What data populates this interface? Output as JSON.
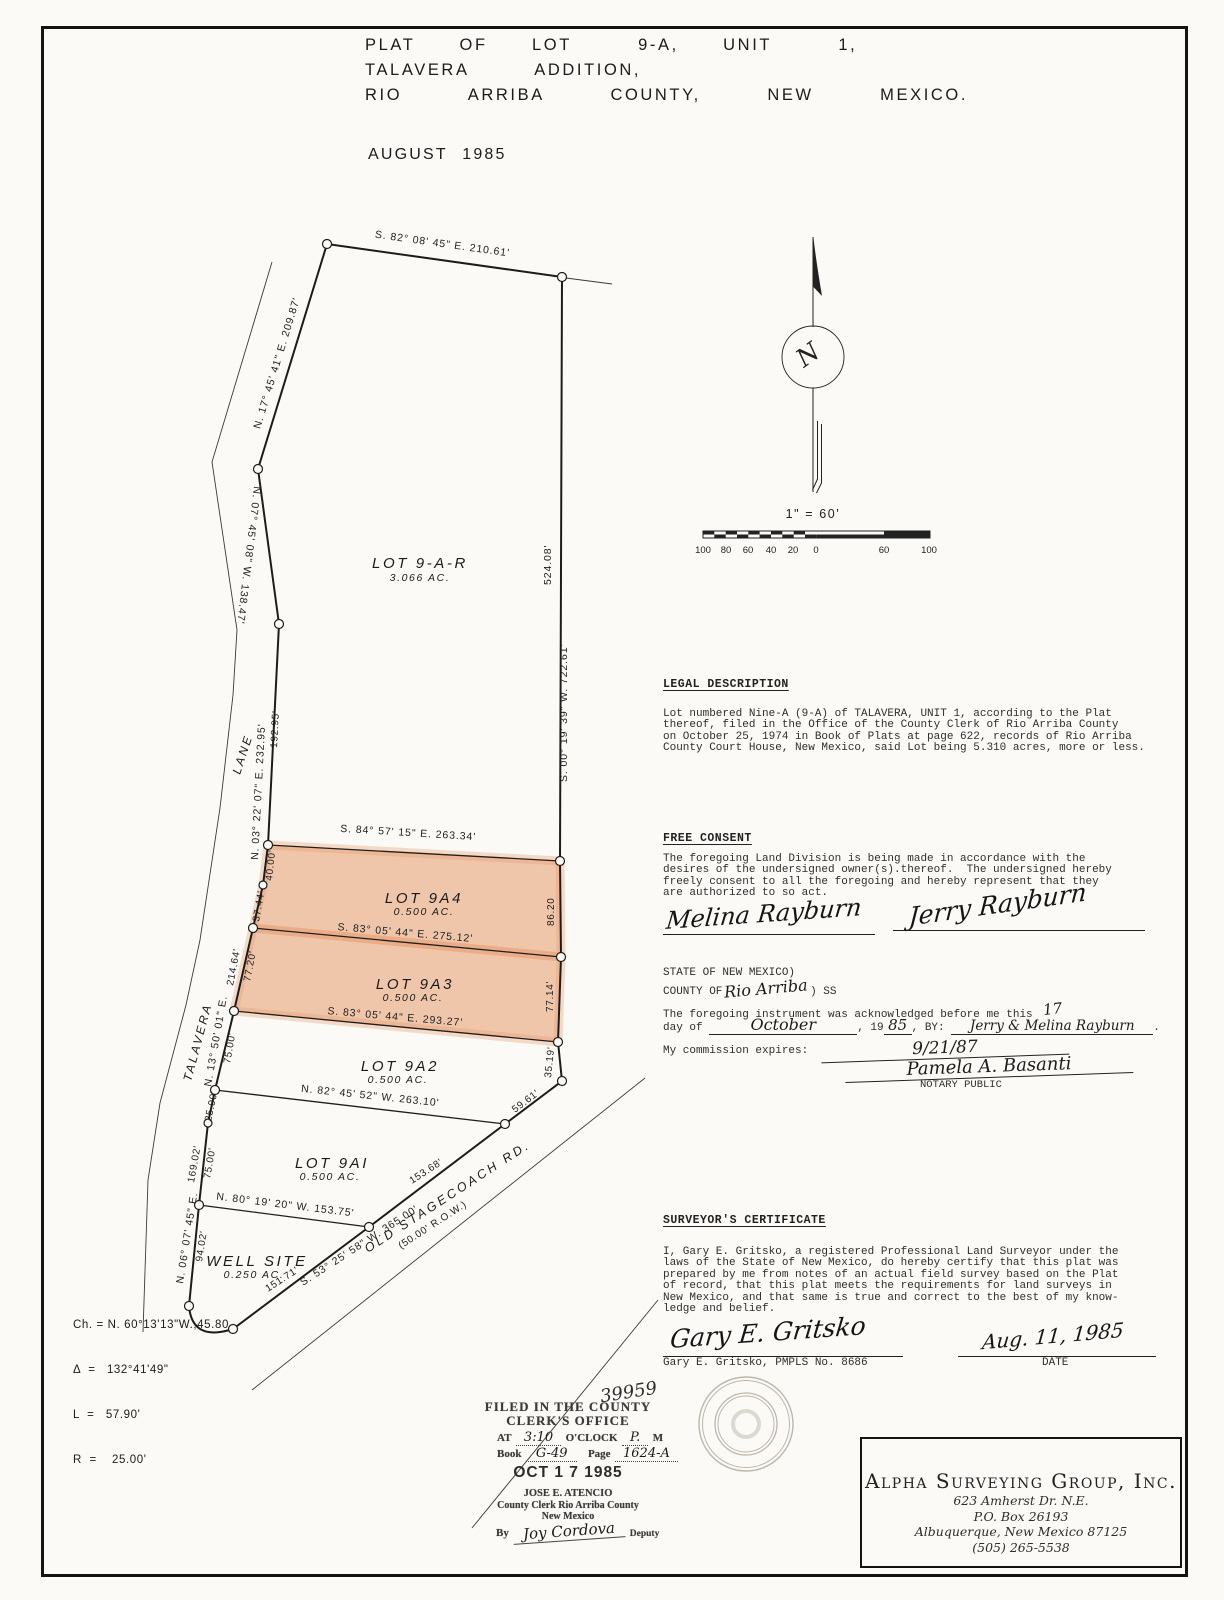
{
  "title": {
    "line1": "PLAT  OF  LOT   9-A,  UNIT   1,",
    "line2": "TALAVERA   ADDITION,",
    "line3": "RIO   ARRIBA   COUNTY,   NEW   MEXICO.",
    "date": "AUGUST  1985"
  },
  "north": {
    "letter": "N",
    "scale_label": "1\" = 60'",
    "ticks": [
      "100",
      "80",
      "60",
      "40",
      "20",
      "0",
      "60",
      "100"
    ]
  },
  "drawing": {
    "lane_upper": "LANE",
    "lane_lower": "TALAVERA",
    "road_name": "OLD  STAGECOACH  RD.",
    "road_row": "(50.00'  R.O.W.)",
    "b_top": "S.  82°  08'  45\"   E.    210.61'",
    "b_nw1": "N. 17° 45' 41\"  E.   209.87'",
    "b_nw2": "N. 07° 45' 08\" W. 138.47'",
    "b_w1": "N. 03° 22' 07\"  E.   232.95'",
    "d_w1_inner": "192.95'",
    "b_e_outer": "S. 00° 19' 39\" W. 722.61'",
    "d_e_inner": "524.08'",
    "b_9a4_top": "S.  84°  57' 15\"  E.  263.34'",
    "b_9a4_bot": "S.  83°  05' 44\"  E.  275.12'",
    "b_9a3_bot": "S.  83°  05' 44\"  E.  293.27'",
    "b_9a2_bot": "N.   82°  45'  52\"  W.  263.10'",
    "b_9a1_bot": "N.  80°  19'  20\"  W.  153.75'",
    "b_w2": "N. 13° 50' 01\" E.",
    "b_w3": "N. 06° 07' 45\" E.",
    "b_road": "S.  53°  25'  58\"  W.  365.00'",
    "d_40": "40.00'",
    "d_3744": "37.44'",
    "d_8620": "86.20",
    "d_21464": "214.64'",
    "d_7720": "77.20'",
    "d_7714": "77.14'",
    "d_3519": "35.19'",
    "d_5961": "59.61'",
    "d_7500a": "75.00'",
    "d_2500": "25.00'",
    "d_16902": "169.02'",
    "d_7500b": "75.00'",
    "d_9402": "94.02'",
    "d_15368": "153.68'",
    "d_15171": "151.71'",
    "lots": {
      "r": {
        "name": "LOT  9-A-R",
        "area": "3.066   AC."
      },
      "a4": {
        "name": "LOT  9A4",
        "area": "0.500   AC."
      },
      "a3": {
        "name": "LOT  9A3",
        "area": "0.500   AC."
      },
      "a2": {
        "name": "LOT  9A2",
        "area": "0.500    AC."
      },
      "a1": {
        "name": "LOT  9AI",
        "area": "0.500   AC."
      },
      "well": {
        "name": "WELL   SITE",
        "area": "0.250   AC."
      }
    },
    "curve": {
      "ch": "Ch. = N. 60°13'13\"W.,45.80",
      "delta": "Δ  =   132°41'49\"",
      "l": "L  =   57.90'",
      "r": "R  =    25.00'"
    }
  },
  "legal": {
    "heading": "LEGAL DESCRIPTION",
    "body": [
      "Lot numbered Nine-A (9-A) of TALAVERA, UNIT 1, according to the Plat",
      "thereof, filed in the Office of the County Clerk of Rio Arriba County",
      "on October 25, 1974 in Book of Plats at page 622, records of Rio Arriba",
      "County Court House, New Mexico, said Lot being 5.310 acres, more or less."
    ]
  },
  "consent": {
    "heading": "FREE CONSENT",
    "body": [
      "The foregoing Land Division is being made in accordance with the",
      "desires of the undersigned owner(s).thereof.  The undersigned hereby",
      "freely consent to all the foregoing and hereby represent that they",
      "are authorized to so act."
    ],
    "sig1": "Melina Rayburn",
    "sig2": "Jerry Rayburn"
  },
  "notary": {
    "state": "STATE OF NEW MEXICO)",
    "county_prefix": "COUNTY OF",
    "county_hand": "Rio Arriba",
    "ss": ") SS",
    "ack1": "The foregoing instrument was acknowledged before me this",
    "day_hand": "17",
    "day_of": "day of ",
    "year_pre": ", 19",
    "month_hand": "October",
    "year_hand": "85",
    "by_label": ", BY: ",
    "names_hand": "Jerry & Melina Rayburn",
    "period": ".",
    "expires_label": "My commission expires:",
    "expires_hand": "9/21/87",
    "notary_sig": "Pamela A. Basanti",
    "notary_title": "NOTARY PUBLIC"
  },
  "certificate": {
    "heading": "SURVEYOR'S CERTIFICATE",
    "body": [
      "I, Gary E. Gritsko, a registered Professional Land Surveyor under the",
      "laws of the State of New Mexico, do hereby certify that this plat was",
      "prepared by me from notes of an actual field survey based on the Plat",
      "of record, that this plat meets the requirements for land surveys in",
      "New Mexico, and that same is true and correct to the best of my know-",
      "ledge and belief."
    ],
    "sig": "Gary E. Gritsko",
    "sig_printed": "Gary E. Gritsko, PMPLS No. 8686",
    "date_hand": "Aug. 11, 1985",
    "date_label": "DATE"
  },
  "stamp": {
    "number": "39959",
    "line1": "FILED IN THE COUNTY",
    "line2": "CLERK'S OFFICE",
    "at_label": "AT",
    "time_hand": "3:10",
    "oclock": "O'CLOCK",
    "ampm_hand": "P.",
    "m_label": "M",
    "book_label": "Book",
    "book_hand": "G-49",
    "page_label": "Page",
    "page_hand": "1624-A",
    "date": "OCT 1 7 1985",
    "clerk1": "JOSE E. ATENCIO",
    "clerk2": "County Clerk Rio Arriba County",
    "clerk3": "New Mexico",
    "by_label": "By",
    "deputy_sig": "Joy Cordova",
    "deputy_label": "Deputy"
  },
  "firm": {
    "name": "Alpha Surveying Group, Inc.",
    "addr1": "623 Amherst Dr. N.E.",
    "addr2": "P.O. Box 26193",
    "addr3": "Albuquerque, New Mexico 87125",
    "phone": "(505) 265-5538"
  },
  "colors": {
    "highlight": "#e79a6e",
    "ink": "#1c1c1c"
  }
}
